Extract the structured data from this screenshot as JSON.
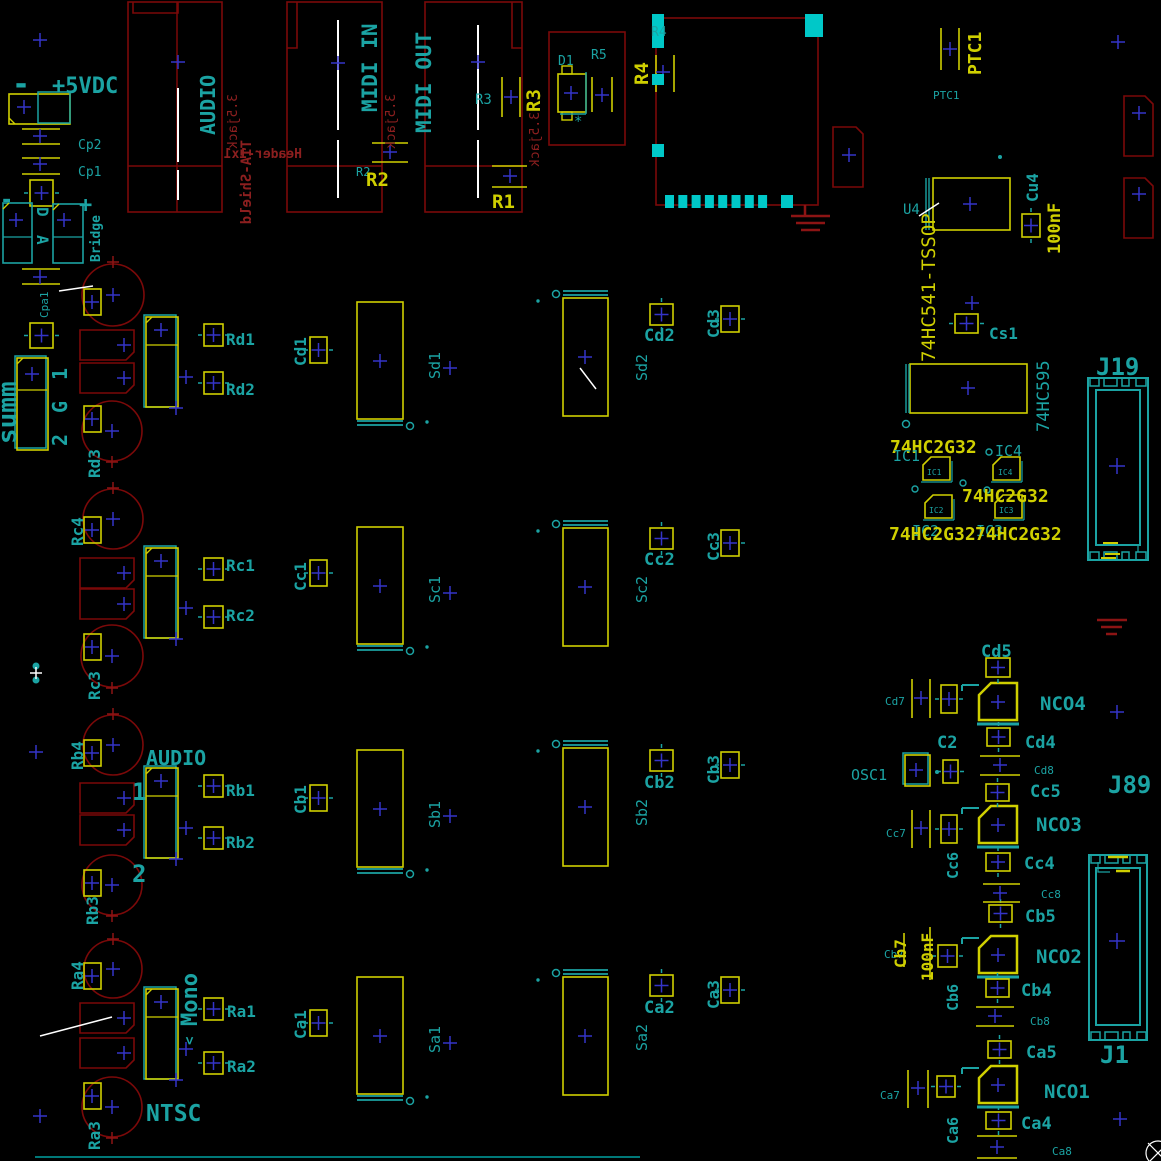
{
  "colors": {
    "teal": "#1BA3A3",
    "yellow": "#CFCF00",
    "red": "#7B0909",
    "red_text": "#8C1F1F",
    "cyan": "#00C8C8",
    "blue": "#3434C8",
    "white": "#FFFFFF",
    "trace": "#007878"
  },
  "texts": [
    {
      "n": "minus-top",
      "t": "-",
      "x": 12,
      "y": 94,
      "s": 30,
      "c": "teal",
      "b": true
    },
    {
      "n": "plus-5vdc",
      "t": "+5VDC",
      "x": 52,
      "y": 93,
      "s": 22,
      "c": "teal",
      "b": true
    },
    {
      "n": "cp2",
      "t": "Cp2",
      "x": 78,
      "y": 149,
      "s": 13,
      "c": "teal"
    },
    {
      "n": "cp1",
      "t": "Cp1",
      "x": 78,
      "y": 176,
      "s": 13,
      "c": "teal"
    },
    {
      "n": "bridge-minus",
      "t": "-",
      "x": 0,
      "y": 207,
      "s": 22,
      "c": "teal",
      "b": true
    },
    {
      "n": "bridge-plus",
      "t": "+",
      "x": 79,
      "y": 212,
      "s": 22,
      "c": "teal",
      "b": true
    },
    {
      "n": "bridge-d",
      "t": "D",
      "x": 37,
      "y": 207,
      "s": 16,
      "c": "teal",
      "r": 90,
      "b": true
    },
    {
      "n": "bridge-a",
      "t": "A",
      "x": 37,
      "y": 235,
      "s": 16,
      "c": "teal",
      "r": 90,
      "b": true
    },
    {
      "n": "bridge",
      "t": "Bridge",
      "x": 100,
      "y": 262,
      "s": 13,
      "c": "teal",
      "r": -90,
      "b": true
    },
    {
      "n": "cpa1",
      "t": "Cpa1",
      "x": 48,
      "y": 318,
      "s": 11,
      "c": "teal",
      "r": -90
    },
    {
      "n": "summ",
      "t": "summ",
      "x": 16,
      "y": 444,
      "s": 26,
      "c": "teal",
      "r": -90,
      "b": true
    },
    {
      "n": "summ-pin1",
      "t": "1",
      "x": 67,
      "y": 380,
      "s": 20,
      "c": "teal",
      "r": -90,
      "b": true
    },
    {
      "n": "summ-ping",
      "t": "G",
      "x": 67,
      "y": 413,
      "s": 20,
      "c": "teal",
      "r": -90,
      "b": true
    },
    {
      "n": "summ-pin2",
      "t": "2",
      "x": 67,
      "y": 446,
      "s": 20,
      "c": "teal",
      "r": -90,
      "b": true
    },
    {
      "n": "audio-jack-label",
      "t": "AUDIO",
      "x": 215,
      "y": 135,
      "s": 20,
      "c": "teal",
      "r": -90,
      "b": true
    },
    {
      "n": "header-1x1",
      "t": "Header-1x1",
      "x": 302,
      "y": 158,
      "s": 13,
      "c": "red",
      "m": true,
      "b": true
    },
    {
      "n": "tia-shield",
      "t": "TIA-Shield",
      "x": 251,
      "y": 140,
      "s": 14,
      "c": "red",
      "r": -90,
      "m": true,
      "b": true
    },
    {
      "n": "jack35-audio",
      "t": "3.5jack",
      "x": 237,
      "y": 94,
      "s": 13,
      "c": "red",
      "r": -90,
      "m": true
    },
    {
      "n": "midi-in-label",
      "t": "MIDI IN",
      "x": 377,
      "y": 112,
      "s": 21,
      "c": "teal",
      "r": -90,
      "b": true
    },
    {
      "n": "jack35-midiin",
      "t": "3.5jack",
      "x": 395,
      "y": 94,
      "s": 13,
      "c": "red",
      "r": -90,
      "m": true
    },
    {
      "n": "r2-ref",
      "t": "R2",
      "x": 356,
      "y": 176,
      "s": 12,
      "c": "teal"
    },
    {
      "n": "r2",
      "t": "R2",
      "x": 366,
      "y": 186,
      "s": 19,
      "c": "yellow",
      "b": true
    },
    {
      "n": "midi-out-label",
      "t": "MIDI OUT",
      "x": 431,
      "y": 133,
      "s": 21,
      "c": "teal",
      "r": -90,
      "b": true
    },
    {
      "n": "r3-ref",
      "t": "R3",
      "x": 475,
      "y": 104,
      "s": 14,
      "c": "teal"
    },
    {
      "n": "r3",
      "t": "R3",
      "x": 540,
      "y": 112,
      "s": 19,
      "c": "yellow",
      "r": -90,
      "b": true
    },
    {
      "n": "jack35-midiout",
      "t": "3.5jack",
      "x": 539,
      "y": 112,
      "s": 13,
      "c": "red",
      "r": -90,
      "m": true
    },
    {
      "n": "r1",
      "t": "R1",
      "x": 492,
      "y": 208,
      "s": 19,
      "c": "yellow",
      "b": true
    },
    {
      "n": "d1",
      "t": "D1",
      "x": 558,
      "y": 65,
      "s": 13,
      "c": "teal"
    },
    {
      "n": "r5",
      "t": "R5",
      "x": 591,
      "y": 59,
      "s": 13,
      "c": "teal"
    },
    {
      "n": "d1-star",
      "t": "*",
      "x": 574,
      "y": 126,
      "s": 14,
      "c": "teal"
    },
    {
      "n": "r4-ref",
      "t": "R4",
      "x": 651,
      "y": 36,
      "s": 13,
      "c": "teal"
    },
    {
      "n": "r4",
      "t": "R4",
      "x": 648,
      "y": 85,
      "s": 19,
      "c": "yellow",
      "r": -90,
      "b": true
    },
    {
      "n": "ptc1",
      "t": "PTC1",
      "x": 981,
      "y": 75,
      "s": 18,
      "c": "yellow",
      "r": -90,
      "b": true
    },
    {
      "n": "ptc1-ref",
      "t": "PTC1",
      "x": 933,
      "y": 99,
      "s": 11,
      "c": "teal"
    },
    {
      "n": "u4",
      "t": "U4",
      "x": 903,
      "y": 214,
      "s": 14,
      "c": "teal"
    },
    {
      "n": "u4-value",
      "t": "74HC541-TSSOP",
      "x": 935,
      "y": 362,
      "s": 19,
      "c": "yellow",
      "r": -90
    },
    {
      "n": "cu4",
      "t": "Cu4",
      "x": 1038,
      "y": 202,
      "s": 16,
      "c": "teal",
      "r": -90,
      "b": true
    },
    {
      "n": "cu4-value",
      "t": "100nF",
      "x": 1060,
      "y": 254,
      "s": 17,
      "c": "yellow",
      "r": -90,
      "b": true
    },
    {
      "n": "cs1",
      "t": "Cs1",
      "x": 989,
      "y": 339,
      "s": 16,
      "c": "teal",
      "b": true
    },
    {
      "n": "u595-value",
      "t": "74HC595",
      "x": 1049,
      "y": 432,
      "s": 17,
      "c": "teal",
      "r": -90
    },
    {
      "n": "hc2g32-1",
      "t": "74HC2G32",
      "x": 890,
      "y": 453,
      "s": 18,
      "c": "yellow",
      "b": true
    },
    {
      "n": "ic1",
      "t": "IC1",
      "x": 893,
      "y": 461,
      "s": 15,
      "c": "teal"
    },
    {
      "n": "ic4",
      "t": "IC4",
      "x": 995,
      "y": 456,
      "s": 15,
      "c": "teal"
    },
    {
      "n": "hc2g32-2",
      "t": "74HC2G32",
      "x": 962,
      "y": 502,
      "s": 18,
      "c": "yellow",
      "b": true
    },
    {
      "n": "ic2",
      "t": "IC2",
      "x": 912,
      "y": 536,
      "s": 15,
      "c": "teal"
    },
    {
      "n": "ic3",
      "t": "IC3",
      "x": 976,
      "y": 536,
      "s": 15,
      "c": "teal"
    },
    {
      "n": "hc2g32-3",
      "t": "74HC2G32",
      "x": 889,
      "y": 540,
      "s": 18,
      "c": "yellow",
      "b": true
    },
    {
      "n": "hc2g32-4",
      "t": "74HC2G32",
      "x": 975,
      "y": 540,
      "s": 18,
      "c": "yellow",
      "b": true
    },
    {
      "n": "ic1-sm",
      "t": "IC1",
      "x": 927,
      "y": 475,
      "s": 8,
      "c": "teal"
    },
    {
      "n": "ic4-sm",
      "t": "IC4",
      "x": 998,
      "y": 475,
      "s": 8,
      "c": "teal"
    },
    {
      "n": "ic2-sm",
      "t": "IC2",
      "x": 929,
      "y": 513,
      "s": 8,
      "c": "teal"
    },
    {
      "n": "ic3-sm",
      "t": "IC3",
      "x": 999,
      "y": 513,
      "s": 8,
      "c": "teal"
    },
    {
      "n": "j19",
      "t": "J19",
      "x": 1096,
      "y": 375,
      "s": 24,
      "c": "teal",
      "b": true
    },
    {
      "n": "rd1",
      "t": "Rd1",
      "x": 226,
      "y": 345,
      "s": 16,
      "c": "teal",
      "b": true
    },
    {
      "n": "rd2",
      "t": "Rd2",
      "x": 226,
      "y": 395,
      "s": 16,
      "c": "teal",
      "b": true
    },
    {
      "n": "rd3",
      "t": "Rd3",
      "x": 100,
      "y": 478,
      "s": 16,
      "c": "teal",
      "r": -90,
      "b": true
    },
    {
      "n": "rc4",
      "t": "Rc4",
      "x": 83,
      "y": 546,
      "s": 16,
      "c": "teal",
      "r": -90,
      "b": true
    },
    {
      "n": "rc1",
      "t": "Rc1",
      "x": 226,
      "y": 571,
      "s": 16,
      "c": "teal",
      "b": true
    },
    {
      "n": "rc2",
      "t": "Rc2",
      "x": 226,
      "y": 621,
      "s": 16,
      "c": "teal",
      "b": true
    },
    {
      "n": "rc3",
      "t": "Rc3",
      "x": 100,
      "y": 700,
      "s": 16,
      "c": "teal",
      "r": -90,
      "b": true
    },
    {
      "n": "rb4",
      "t": "Rb4",
      "x": 83,
      "y": 770,
      "s": 16,
      "c": "teal",
      "r": -90,
      "b": true
    },
    {
      "n": "audio-channel-label",
      "t": "AUDIO",
      "x": 146,
      "y": 765,
      "s": 20,
      "c": "teal",
      "b": true
    },
    {
      "n": "channel-1",
      "t": "1",
      "x": 132,
      "y": 800,
      "s": 24,
      "c": "teal",
      "b": true
    },
    {
      "n": "rb1",
      "t": "Rb1",
      "x": 226,
      "y": 796,
      "s": 16,
      "c": "teal",
      "b": true
    },
    {
      "n": "rb2",
      "t": "Rb2",
      "x": 226,
      "y": 848,
      "s": 16,
      "c": "teal",
      "b": true
    },
    {
      "n": "channel-2",
      "t": "2",
      "x": 132,
      "y": 882,
      "s": 24,
      "c": "teal",
      "b": true
    },
    {
      "n": "rb3",
      "t": "Rb3",
      "x": 98,
      "y": 925,
      "s": 16,
      "c": "teal",
      "r": -90,
      "b": true
    },
    {
      "n": "ra4",
      "t": "Ra4",
      "x": 83,
      "y": 990,
      "s": 16,
      "c": "teal",
      "r": -90,
      "b": true
    },
    {
      "n": "mono",
      "t": "Mono",
      "x": 197,
      "y": 1026,
      "s": 22,
      "c": "teal",
      "r": -90,
      "b": true
    },
    {
      "n": "mono-arrow",
      "t": "<",
      "x": 194,
      "y": 1045,
      "s": 14,
      "c": "teal",
      "r": -90,
      "b": true
    },
    {
      "n": "ra1",
      "t": "Ra1",
      "x": 227,
      "y": 1017,
      "s": 16,
      "c": "teal",
      "b": true
    },
    {
      "n": "ra2",
      "t": "Ra2",
      "x": 227,
      "y": 1072,
      "s": 16,
      "c": "teal",
      "b": true
    },
    {
      "n": "ntsc",
      "t": "NTSC",
      "x": 146,
      "y": 1121,
      "s": 23,
      "c": "teal",
      "b": true
    },
    {
      "n": "ra3",
      "t": "Ra3",
      "x": 100,
      "y": 1150,
      "s": 16,
      "c": "teal",
      "r": -90,
      "b": true
    },
    {
      "n": "cd1",
      "t": "Cd1",
      "x": 306,
      "y": 366,
      "s": 16,
      "c": "teal",
      "r": -90,
      "b": true
    },
    {
      "n": "sd1",
      "t": "Sd1",
      "x": 440,
      "y": 379,
      "s": 15,
      "c": "teal",
      "r": -90
    },
    {
      "n": "sd2",
      "t": "Sd2",
      "x": 647,
      "y": 381,
      "s": 15,
      "c": "teal",
      "r": -90
    },
    {
      "n": "cd2",
      "t": "Cd2",
      "x": 644,
      "y": 341,
      "s": 17,
      "c": "teal",
      "b": true
    },
    {
      "n": "cd3",
      "t": "Cd3",
      "x": 719,
      "y": 338,
      "s": 16,
      "c": "teal",
      "r": -90,
      "b": true
    },
    {
      "n": "cc1",
      "t": "Cc1",
      "x": 306,
      "y": 591,
      "s": 16,
      "c": "teal",
      "r": -90,
      "b": true
    },
    {
      "n": "sc1",
      "t": "Sc1",
      "x": 440,
      "y": 603,
      "s": 15,
      "c": "teal",
      "r": -90
    },
    {
      "n": "sc2",
      "t": "Sc2",
      "x": 647,
      "y": 603,
      "s": 15,
      "c": "teal",
      "r": -90
    },
    {
      "n": "cc2",
      "t": "Cc2",
      "x": 644,
      "y": 565,
      "s": 17,
      "c": "teal",
      "b": true
    },
    {
      "n": "cc3",
      "t": "Cc3",
      "x": 719,
      "y": 561,
      "s": 16,
      "c": "teal",
      "r": -90,
      "b": true
    },
    {
      "n": "cb1",
      "t": "Cb1",
      "x": 306,
      "y": 814,
      "s": 16,
      "c": "teal",
      "r": -90,
      "b": true
    },
    {
      "n": "sb1",
      "t": "Sb1",
      "x": 440,
      "y": 828,
      "s": 15,
      "c": "teal",
      "r": -90
    },
    {
      "n": "sb2",
      "t": "Sb2",
      "x": 647,
      "y": 826,
      "s": 15,
      "c": "teal",
      "r": -90
    },
    {
      "n": "cb2",
      "t": "Cb2",
      "x": 644,
      "y": 788,
      "s": 17,
      "c": "teal",
      "b": true
    },
    {
      "n": "cb3",
      "t": "Cb3",
      "x": 719,
      "y": 784,
      "s": 16,
      "c": "teal",
      "r": -90,
      "b": true
    },
    {
      "n": "ca1",
      "t": "Ca1",
      "x": 306,
      "y": 1039,
      "s": 16,
      "c": "teal",
      "r": -90,
      "b": true
    },
    {
      "n": "sa1",
      "t": "Sa1",
      "x": 440,
      "y": 1053,
      "s": 15,
      "c": "teal",
      "r": -90
    },
    {
      "n": "sa2",
      "t": "Sa2",
      "x": 647,
      "y": 1051,
      "s": 15,
      "c": "teal",
      "r": -90
    },
    {
      "n": "ca2",
      "t": "Ca2",
      "x": 644,
      "y": 1013,
      "s": 17,
      "c": "teal",
      "b": true
    },
    {
      "n": "ca3",
      "t": "Ca3",
      "x": 719,
      "y": 1009,
      "s": 16,
      "c": "teal",
      "r": -90,
      "b": true
    },
    {
      "n": "cd5",
      "t": "Cd5",
      "x": 981,
      "y": 657,
      "s": 17,
      "c": "teal",
      "b": true
    },
    {
      "n": "nco4",
      "t": "NCO4",
      "x": 1040,
      "y": 710,
      "s": 19,
      "c": "teal",
      "b": true
    },
    {
      "n": "cd7",
      "t": "Cd7",
      "x": 885,
      "y": 705,
      "s": 11,
      "c": "teal"
    },
    {
      "n": "c2",
      "t": "C2",
      "x": 937,
      "y": 748,
      "s": 17,
      "c": "teal",
      "b": true
    },
    {
      "n": "cd4",
      "t": "Cd4",
      "x": 1025,
      "y": 748,
      "s": 17,
      "c": "teal",
      "b": true
    },
    {
      "n": "cd8",
      "t": "Cd8",
      "x": 1034,
      "y": 774,
      "s": 11,
      "c": "teal"
    },
    {
      "n": "osc1",
      "t": "OSC1",
      "x": 851,
      "y": 780,
      "s": 15,
      "c": "teal"
    },
    {
      "n": "cc5",
      "t": "Cc5",
      "x": 1030,
      "y": 797,
      "s": 17,
      "c": "teal",
      "b": true
    },
    {
      "n": "nco3",
      "t": "NCO3",
      "x": 1036,
      "y": 831,
      "s": 19,
      "c": "teal",
      "b": true
    },
    {
      "n": "cc7",
      "t": "Cc7",
      "x": 886,
      "y": 837,
      "s": 11,
      "c": "teal"
    },
    {
      "n": "cc6",
      "t": "Cc6",
      "x": 958,
      "y": 879,
      "s": 15,
      "c": "teal",
      "r": -90,
      "b": true
    },
    {
      "n": "cc4",
      "t": "Cc4",
      "x": 1024,
      "y": 869,
      "s": 17,
      "c": "teal",
      "b": true
    },
    {
      "n": "cc8",
      "t": "Cc8",
      "x": 1041,
      "y": 898,
      "s": 11,
      "c": "teal"
    },
    {
      "n": "j89",
      "t": "J89",
      "x": 1108,
      "y": 793,
      "s": 24,
      "c": "teal",
      "b": true
    },
    {
      "n": "cb5",
      "t": "Cb5",
      "x": 1025,
      "y": 922,
      "s": 17,
      "c": "teal",
      "b": true
    },
    {
      "n": "nco2",
      "t": "NCO2",
      "x": 1036,
      "y": 963,
      "s": 19,
      "c": "teal",
      "b": true
    },
    {
      "n": "cb7-ref",
      "t": "Cb7",
      "x": 884,
      "y": 958,
      "s": 11,
      "c": "teal"
    },
    {
      "n": "cb7",
      "t": "Cb7",
      "x": 906,
      "y": 968,
      "s": 16,
      "c": "yellow",
      "r": -90,
      "b": true
    },
    {
      "n": "cb7-value",
      "t": "100nF",
      "x": 933,
      "y": 981,
      "s": 16,
      "c": "yellow",
      "r": -90,
      "b": true
    },
    {
      "n": "cb6",
      "t": "Cb6",
      "x": 958,
      "y": 1011,
      "s": 15,
      "c": "teal",
      "r": -90,
      "b": true
    },
    {
      "n": "cb4",
      "t": "Cb4",
      "x": 1021,
      "y": 996,
      "s": 17,
      "c": "teal",
      "b": true
    },
    {
      "n": "cb8",
      "t": "Cb8",
      "x": 1030,
      "y": 1025,
      "s": 11,
      "c": "teal"
    },
    {
      "n": "ca5",
      "t": "Ca5",
      "x": 1026,
      "y": 1058,
      "s": 17,
      "c": "teal",
      "b": true
    },
    {
      "n": "nco1",
      "t": "NCO1",
      "x": 1044,
      "y": 1098,
      "s": 19,
      "c": "teal",
      "b": true
    },
    {
      "n": "ca7",
      "t": "Ca7",
      "x": 880,
      "y": 1099,
      "s": 11,
      "c": "teal"
    },
    {
      "n": "ca6",
      "t": "Ca6",
      "x": 958,
      "y": 1144,
      "s": 15,
      "c": "teal",
      "r": -90,
      "b": true
    },
    {
      "n": "ca4",
      "t": "Ca4",
      "x": 1021,
      "y": 1129,
      "s": 17,
      "c": "teal",
      "b": true
    },
    {
      "n": "ca8",
      "t": "Ca8",
      "x": 1052,
      "y": 1155,
      "s": 11,
      "c": "teal"
    },
    {
      "n": "j1",
      "t": "J1",
      "x": 1100,
      "y": 1063,
      "s": 24,
      "c": "teal",
      "b": true
    }
  ]
}
